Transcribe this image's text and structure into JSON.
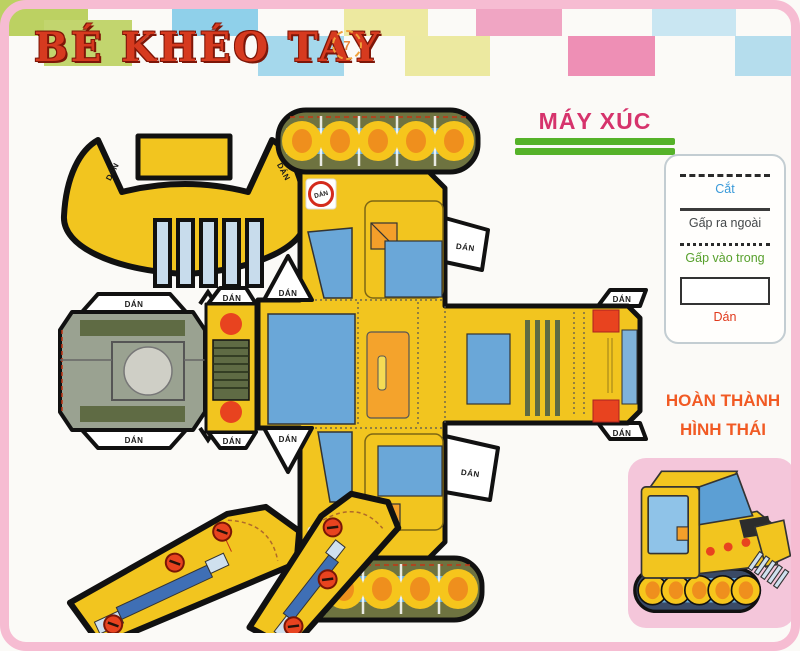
{
  "page": {
    "background": "#fbfaf7",
    "frame_color": "#f6bcd2"
  },
  "header": {
    "title": "BÉ KHÉO TAY",
    "title_color": "#d63a1f",
    "page_number": "7"
  },
  "heading": {
    "text": "MÁY XÚC",
    "color": "#d6336c",
    "underline_color": "#55b229"
  },
  "legend": {
    "items": [
      {
        "style": "dashed",
        "label": "Cắt",
        "color": "#3a9ad9"
      },
      {
        "style": "solid",
        "label": "Gấp ra ngoài",
        "color": "#44484a"
      },
      {
        "style": "dotted",
        "label": "Gấp vào trong",
        "color": "#57a02c"
      },
      {
        "style": "box",
        "label": "Dán",
        "color": "#e0391c"
      }
    ]
  },
  "completed": {
    "line1": "HOÀN THÀNH",
    "line2": "HÌNH THÁI",
    "color": "#f15a24"
  },
  "labels": {
    "dan": "DÁN"
  },
  "template_colors": {
    "body_yellow": "#f2c51f",
    "track_olive": "#6e7340",
    "window_blue": "#6aa7d8",
    "underside_gray": "#9aa291",
    "grill_green": "#5f6b44",
    "bolt_red": "#e8431f",
    "door_orange": "#f4a32c"
  },
  "checkerboard": {
    "squares": [
      {
        "x": 0,
        "y": 0,
        "w": 88,
        "h": 36,
        "c": "#bcd162"
      },
      {
        "x": 172,
        "y": 0,
        "w": 86,
        "h": 36,
        "c": "#8fd0ea"
      },
      {
        "x": 344,
        "y": 0,
        "w": 84,
        "h": 36,
        "c": "#ede9a0"
      },
      {
        "x": 476,
        "y": 0,
        "w": 86,
        "h": 36,
        "c": "#f0a5c3"
      },
      {
        "x": 652,
        "y": 0,
        "w": 84,
        "h": 36,
        "c": "#c9e6f2"
      },
      {
        "x": 44,
        "y": 20,
        "w": 88,
        "h": 46,
        "c": "#c2d56e"
      },
      {
        "x": 258,
        "y": 36,
        "w": 86,
        "h": 40,
        "c": "#a5d8ec"
      },
      {
        "x": 405,
        "y": 36,
        "w": 85,
        "h": 40,
        "c": "#ece9a0"
      },
      {
        "x": 568,
        "y": 36,
        "w": 87,
        "h": 40,
        "c": "#ee8fb5"
      },
      {
        "x": 735,
        "y": 36,
        "w": 65,
        "h": 40,
        "c": "#b5dded"
      }
    ]
  }
}
